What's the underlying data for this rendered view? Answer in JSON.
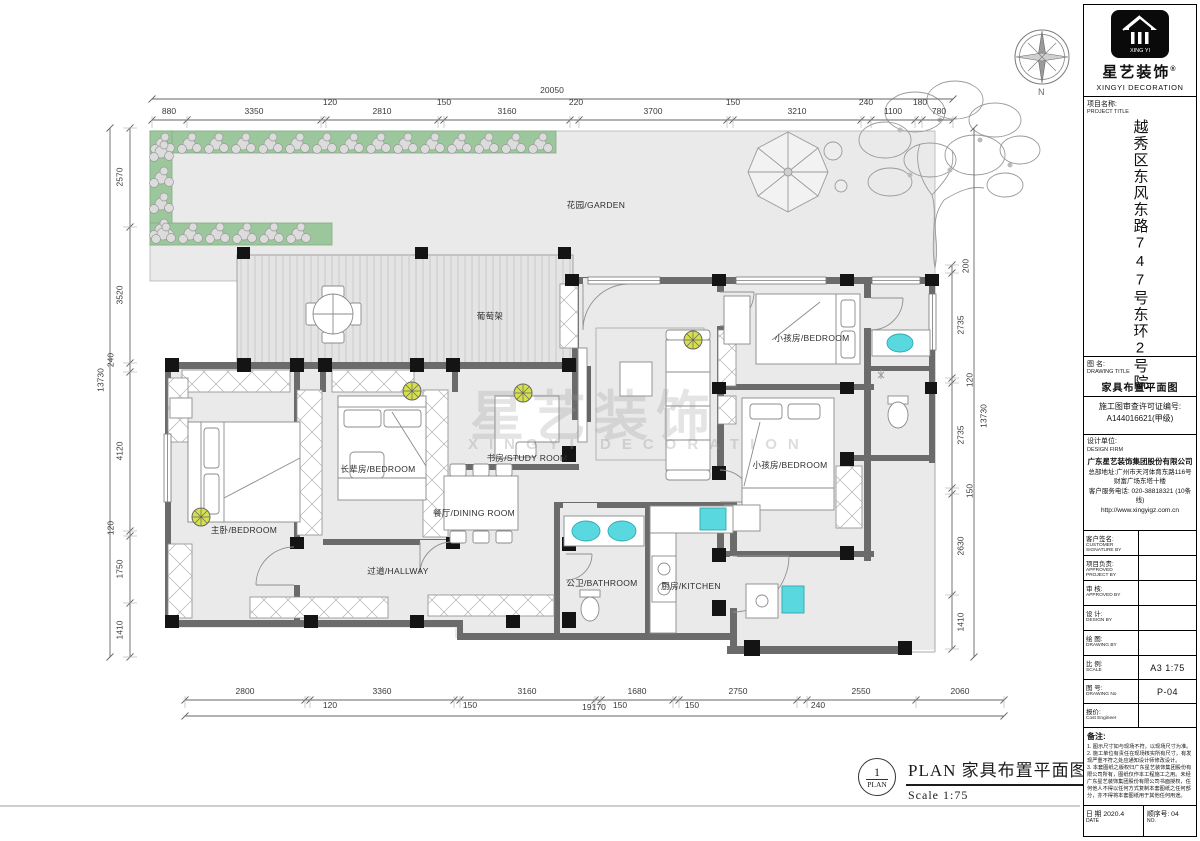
{
  "sheet": {
    "footer": {
      "circle_number": "1",
      "circle_label": "PLAN",
      "title": "PLAN  家具布置平面图",
      "scale": "Scale 1:75"
    },
    "compass_letter": "N",
    "watermark_zh": "星艺装饰",
    "watermark_en": "XINGYI DECORATION"
  },
  "rooms": [
    {
      "id": "garden",
      "label": "花园/GARDEN"
    },
    {
      "id": "trellis",
      "label": "葡萄架"
    },
    {
      "id": "study",
      "label": "书房/STUDY ROOM"
    },
    {
      "id": "elder-bedroom",
      "label": "长辈房/BEDROOM"
    },
    {
      "id": "master-bedroom",
      "label": "主卧/BEDROOM"
    },
    {
      "id": "dining",
      "label": "餐厅/DINING ROOM"
    },
    {
      "id": "hallway",
      "label": "过道/HALLWAY"
    },
    {
      "id": "bathroom",
      "label": "公卫/BATHROOM"
    },
    {
      "id": "kitchen",
      "label": "厨房/KITCHEN"
    },
    {
      "id": "kids-bedroom-1",
      "label": "小孩房/BEDROOM"
    },
    {
      "id": "kids-bedroom-2",
      "label": "小孩房/BEDROOM"
    }
  ],
  "dimensions": {
    "top": {
      "total": "20050",
      "segments": [
        "880",
        "3350",
        "120",
        "2810",
        "150",
        "3160",
        "220",
        "3700",
        "150",
        "3210",
        "240",
        "1100",
        "180",
        "780"
      ]
    },
    "bottom": {
      "total": "19170",
      "segments": [
        "2800",
        "120",
        "3360",
        "150",
        "3160",
        "150",
        "1680",
        "150",
        "2750",
        "240",
        "2550",
        "2060"
      ]
    },
    "left": {
      "total": "13730",
      "segments": [
        "2570",
        "3520",
        "240",
        "4120",
        "120",
        "1750",
        "1410"
      ]
    },
    "right": {
      "total": "13730",
      "segments": [
        "200",
        "2735",
        "120",
        "2735",
        "150",
        "2630",
        "1410"
      ]
    }
  },
  "titleblock": {
    "brand": {
      "badge": "XING YI",
      "name_zh": "星艺装饰",
      "reg": "®",
      "name_en": "XINGYI DECORATION"
    },
    "project_label_zh": "项目名称:",
    "project_label_en": "PROJECT TITLE",
    "project_title": "越秀区东风东路747号东环2号院",
    "drawing_label_zh": "图 名:",
    "drawing_label_en": "DRAWING TITLE",
    "drawing_title": "家具布置平面图",
    "permit_line1": "施工图审查许可证编号:",
    "permit_line2": "A144016621(甲级)",
    "firm_label_zh": "设计单位:",
    "firm_label_en": "DESIGN FIRM",
    "firm_name": "广东星艺装饰集团股份有限公司",
    "firm_addr1": "总部地址:广州市天河体育东路116号",
    "firm_addr2": "财富广场东塔十楼",
    "firm_phone": "客户服务电话: 020-38818321 (10条线)",
    "firm_url": "http://www.xingyigz.com.cn",
    "signoff_rows": [
      {
        "zh": "客户签名:",
        "en": "CUSTOMER SIGNATURE BY"
      },
      {
        "zh": "项目负责:",
        "en": "APPROVED PROJECT BY"
      },
      {
        "zh": "审 核:",
        "en": "APPROVED BY"
      },
      {
        "zh": "设 计:",
        "en": "DESIGN BY"
      },
      {
        "zh": "绘 图:",
        "en": "DRAWING BY"
      }
    ],
    "scale_rows": [
      {
        "zh": "比 例:",
        "en": "SCALE",
        "value": "A3 1:75"
      },
      {
        "zh": "图 号:",
        "en": "DRAWING No",
        "value": "P-04"
      },
      {
        "zh": "报价:",
        "en": "Cost Engineer",
        "value": ""
      }
    ],
    "notes_title": "备注:",
    "notes": [
      "1. 图示尺寸如与现场不符，以现场尺寸为准。",
      "2. 施工单位有责任在现场核实所有尺寸，有发现严重不符之处应通知设计师修改设计。",
      "3. 本套图纸之版权归广东星艺装饰集团股份有限公司所有，图纸仅作本工程施工之用。未经广东星艺装饰集团股份有限公司书面授权，任何他人不得以任何方式复制本套图纸之任何部分，亦不得将本套图纸用于其他任何用途。"
    ],
    "date_zh": "日 期 2020.4",
    "date_en": "DATE",
    "no_zh": "顺序号:  04",
    "no_en": "NO."
  },
  "colors": {
    "wall": "#6b6b6b",
    "column": "#141414",
    "floor": "#eaeaea",
    "garden_band": "#9cc79c",
    "fixture": "#5ad8e0",
    "light": "#d6e04c"
  }
}
